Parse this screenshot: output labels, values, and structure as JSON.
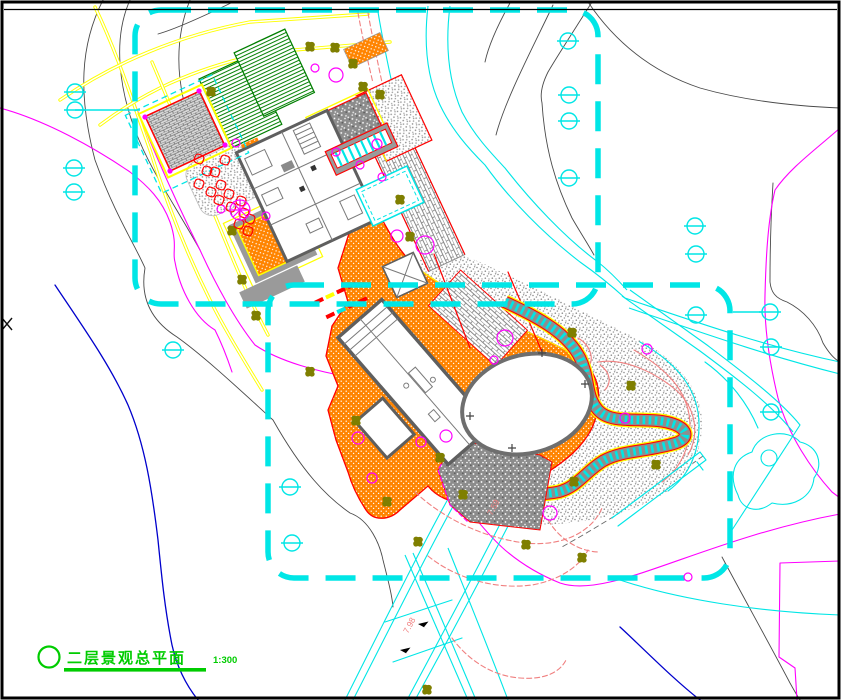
{
  "title_block": {
    "title": "二层景观总平面",
    "scale": "1:300"
  },
  "labels": {
    "elevations": [
      {
        "text": "7.98",
        "x": 408,
        "y": 634,
        "rot": -62
      },
      {
        "text": "7.59",
        "x": 492,
        "y": 516,
        "rot": -62
      }
    ]
  },
  "colors": {
    "cyan": "#00e6e6",
    "yellow": "#ffff00",
    "magenta": "#ff00ff",
    "green": "#00cc00",
    "bedgreen": "#007f00",
    "red": "#ff0000",
    "salmon": "#f08080",
    "orange": "#ff8400",
    "olive": "#7f7f00",
    "blue": "#0000cc"
  },
  "plan": {
    "survey_markers": [
      [
        75,
        92
      ],
      [
        75,
        110
      ],
      [
        74,
        168
      ],
      [
        74,
        192
      ],
      [
        173,
        350
      ],
      [
        290,
        487
      ],
      [
        292,
        543
      ],
      [
        568,
        41
      ],
      [
        569,
        95
      ],
      [
        569,
        121
      ],
      [
        569,
        178
      ],
      [
        695,
        226
      ],
      [
        696,
        254
      ],
      [
        696,
        315
      ],
      [
        770,
        312
      ],
      [
        771,
        347
      ],
      [
        771,
        412
      ]
    ],
    "marker_lines": [
      [
        75,
        110,
        140,
        110
      ],
      [
        733,
        312,
        762,
        312
      ]
    ],
    "trees": [
      [
        211,
        92
      ],
      [
        310,
        47
      ],
      [
        335,
        48
      ],
      [
        353,
        64
      ],
      [
        363,
        87
      ],
      [
        232,
        231
      ],
      [
        242,
        280
      ],
      [
        256,
        316
      ],
      [
        310,
        372
      ],
      [
        410,
        237
      ],
      [
        356,
        421
      ],
      [
        440,
        458
      ],
      [
        463,
        495
      ],
      [
        387,
        502
      ],
      [
        418,
        542
      ],
      [
        526,
        545
      ],
      [
        582,
        558
      ],
      [
        427,
        690
      ],
      [
        572,
        333
      ],
      [
        631,
        386
      ],
      [
        656,
        465
      ],
      [
        574,
        482
      ],
      [
        400,
        200
      ],
      [
        380,
        95
      ]
    ],
    "shrubs": [
      [
        336,
        75,
        7
      ],
      [
        315,
        68,
        4
      ],
      [
        236,
        143,
        4
      ],
      [
        377,
        144,
        5
      ],
      [
        336,
        152,
        4
      ],
      [
        360,
        165,
        4
      ],
      [
        382,
        177,
        4
      ],
      [
        397,
        236,
        6
      ],
      [
        425,
        245,
        9
      ],
      [
        505,
        338,
        8
      ],
      [
        494,
        360,
        4
      ],
      [
        446,
        436,
        6
      ],
      [
        372,
        478,
        5
      ],
      [
        358,
        438,
        6
      ],
      [
        421,
        442,
        5
      ],
      [
        647,
        349,
        5
      ],
      [
        625,
        418,
        5
      ],
      [
        550,
        513,
        7
      ],
      [
        221,
        209,
        4
      ],
      [
        266,
        216,
        4
      ],
      [
        688,
        577,
        4
      ]
    ],
    "red_shrubs": [
      [
        199,
        159
      ],
      [
        207,
        171
      ],
      [
        199,
        184
      ],
      [
        211,
        192
      ],
      [
        221,
        185
      ],
      [
        219,
        200
      ],
      [
        229,
        194
      ],
      [
        231,
        207
      ],
      [
        241,
        201
      ],
      [
        244,
        213
      ],
      [
        239,
        224
      ],
      [
        250,
        219
      ],
      [
        248,
        231
      ],
      [
        225,
        160
      ],
      [
        215,
        172
      ]
    ],
    "wheel_symbol": [
      240,
      210
    ],
    "flow_arrows": [
      [
        418,
        624,
        -35
      ],
      [
        400,
        650,
        -35
      ]
    ]
  }
}
